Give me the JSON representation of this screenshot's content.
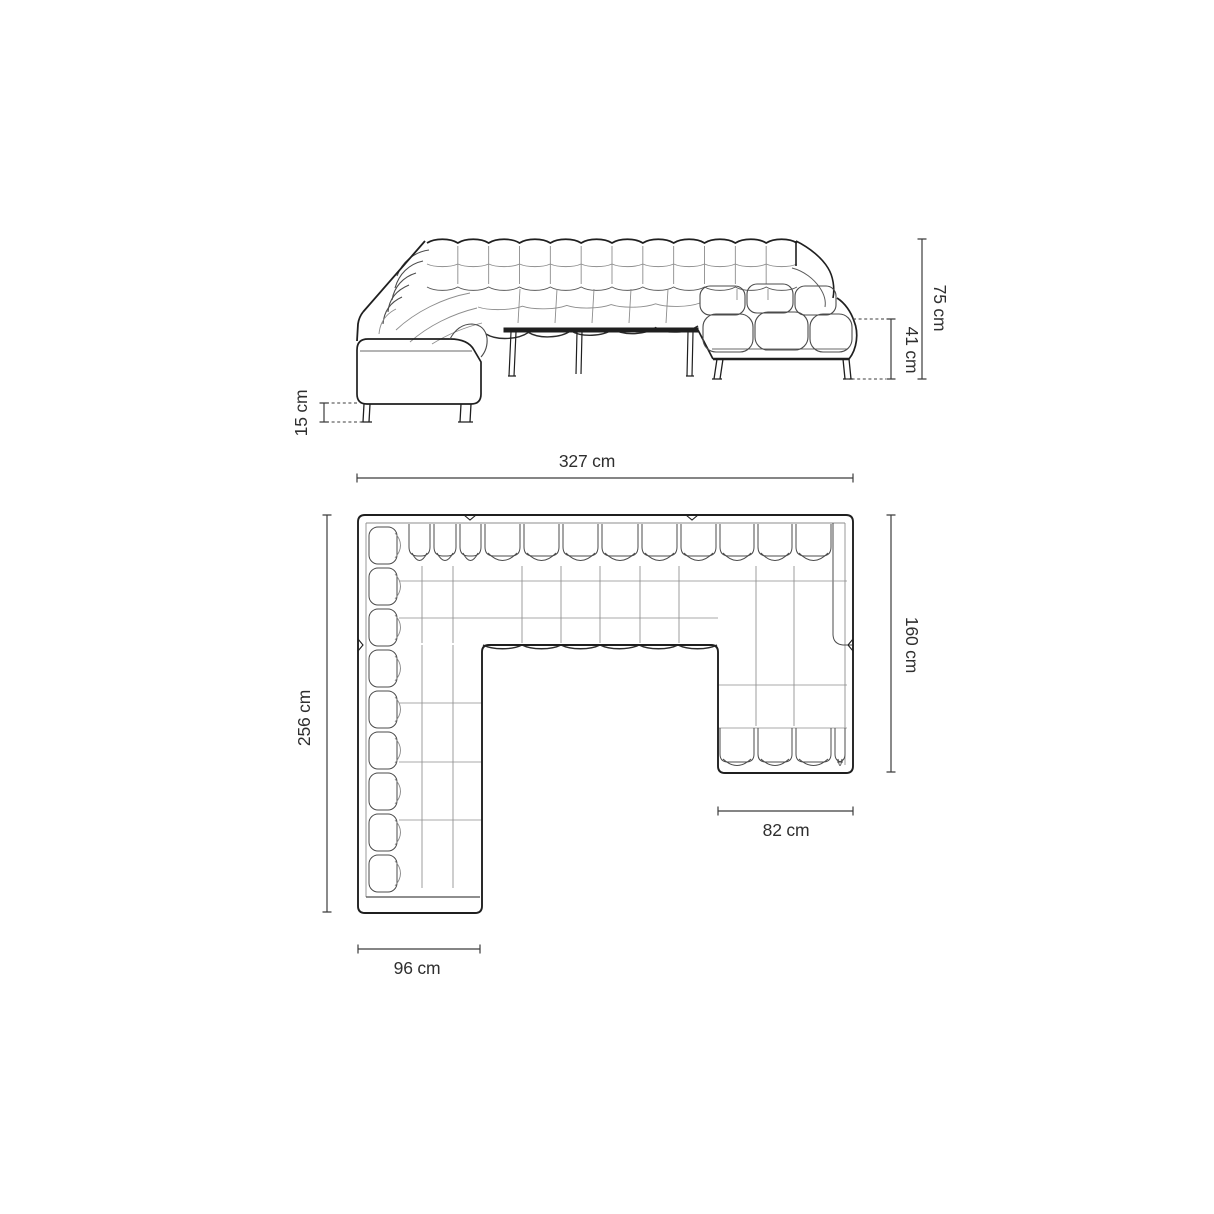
{
  "page": {
    "background": "#ffffff",
    "description": "Technical dimension diagram of a U-shaped tufted corner sofa with chaise, side elevation view above and top plan view below"
  },
  "diagram": {
    "views": [
      {
        "id": "side",
        "name": "side-elevation-view"
      },
      {
        "id": "plan",
        "name": "top-plan-view"
      }
    ],
    "dimensions": {
      "side": [
        {
          "id": "overall-height",
          "label": "75 cm"
        },
        {
          "id": "seat-height",
          "label": "41 cm"
        },
        {
          "id": "leg-height",
          "label": "15 cm"
        }
      ],
      "plan": [
        {
          "id": "overall-width",
          "label": "327 cm"
        },
        {
          "id": "overall-depth",
          "label": "256 cm"
        },
        {
          "id": "chaise-depth",
          "label": "160 cm"
        },
        {
          "id": "chaise-width",
          "label": "82 cm"
        },
        {
          "id": "arm-width",
          "label": "96 cm"
        }
      ]
    }
  },
  "colors": {
    "outline": "#1f1f1f",
    "cushion": "#4b4b4b",
    "grid": "#8d8d8d",
    "dimension": "#3c3c3c",
    "background": "#ffffff"
  }
}
